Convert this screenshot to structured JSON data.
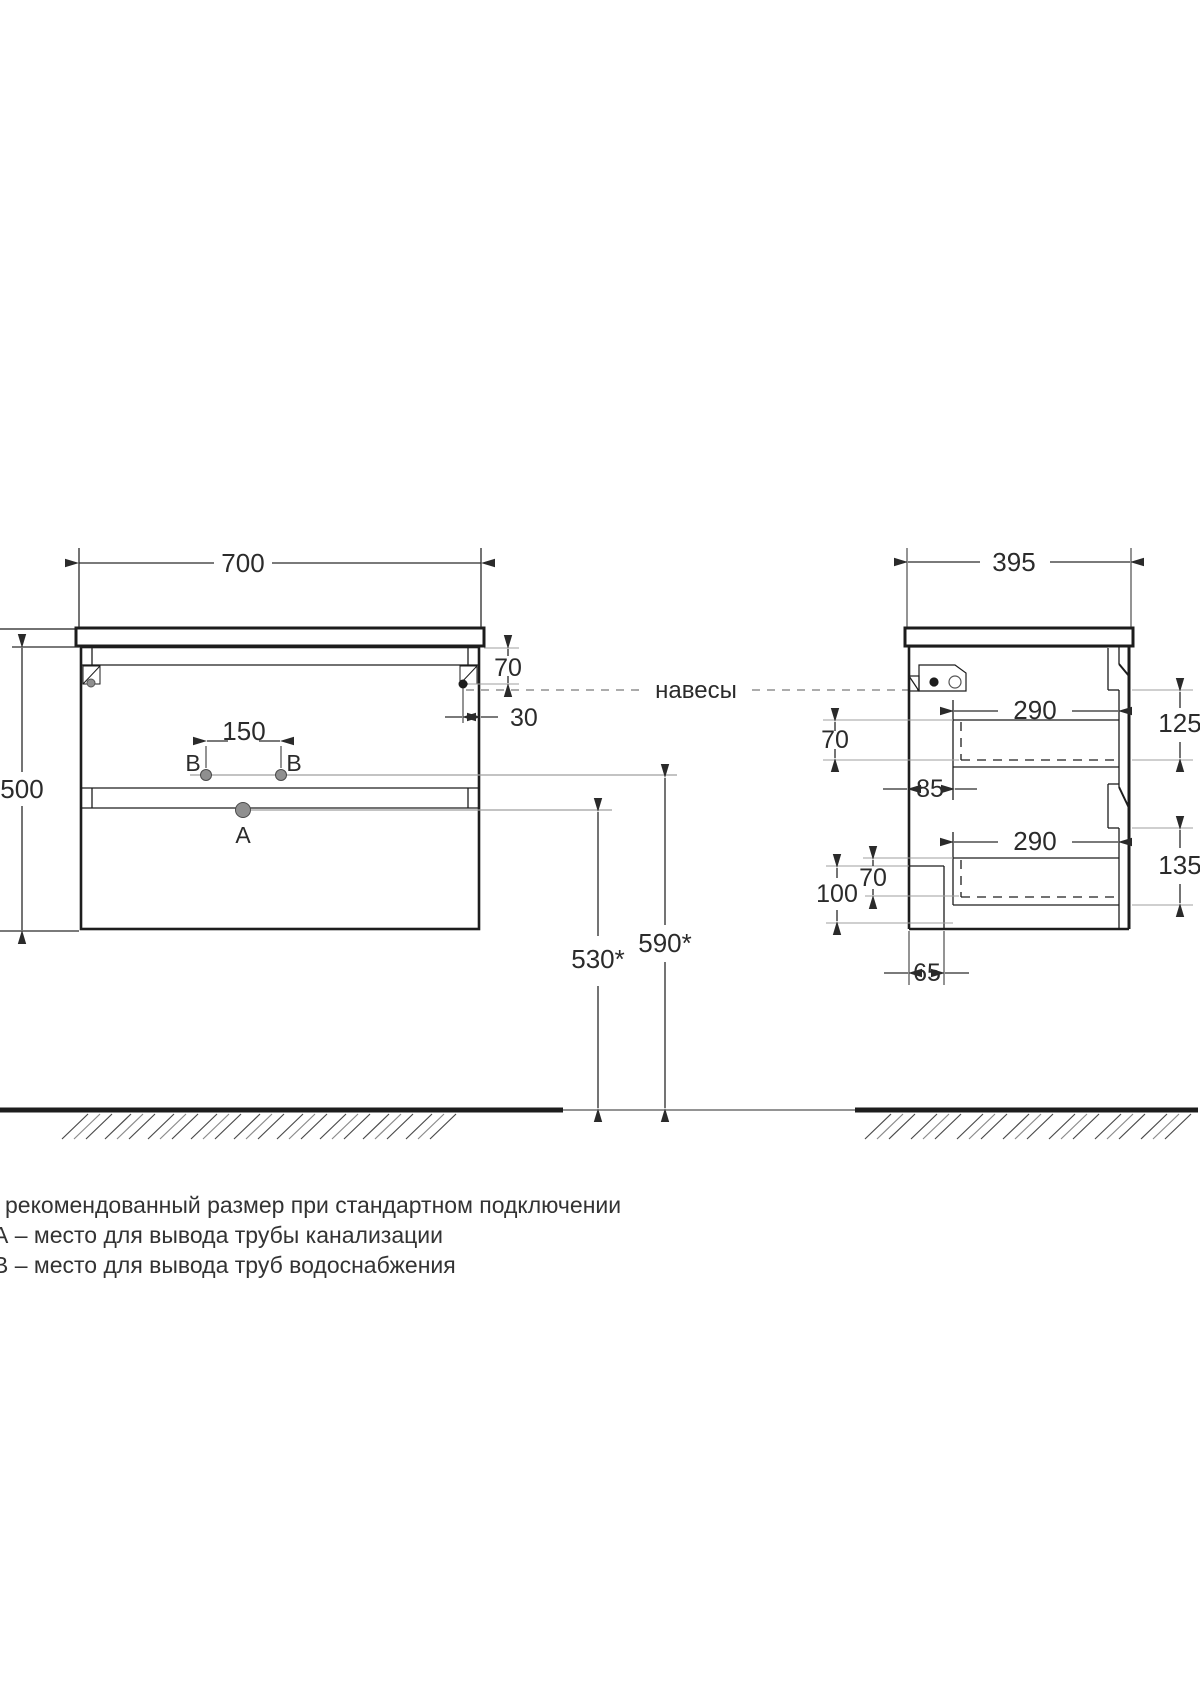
{
  "front_view": {
    "width_dim": "700",
    "height_dim": "500",
    "pipe_spacing_dim": "150",
    "hanger_drop_dim": "70",
    "hanger_inset_dim": "30",
    "drain_height_dim": "530*",
    "water_height_dim": "590*",
    "drain_point_label": "А",
    "water_point_label_left": "В",
    "water_point_label_right": "В"
  },
  "side_view": {
    "depth_dim": "395",
    "top_drawer_depth_dim": "290",
    "bottom_drawer_depth_dim": "290",
    "top_drawer_height_dim": "70",
    "bottom_drawer_height_dim": "70",
    "wall_clearance_dim": "85",
    "top_front_panel_dim": "125",
    "bottom_front_panel_dim": "135",
    "plinth_height_dim": "100",
    "plinth_recess_dim": "65"
  },
  "annotations": {
    "hangers_label": "навесы"
  },
  "legend": {
    "lines": [
      "рекомендованный размер при стандартном подключении",
      "А – место для вывода трубы канализации",
      "В – место для вывода труб водоснабжения"
    ]
  },
  "colors": {
    "line": "#1d1d1d",
    "dim": "#2a2a2a",
    "extension": "#9f9f9f",
    "point_fill": "#8f8f8f"
  }
}
